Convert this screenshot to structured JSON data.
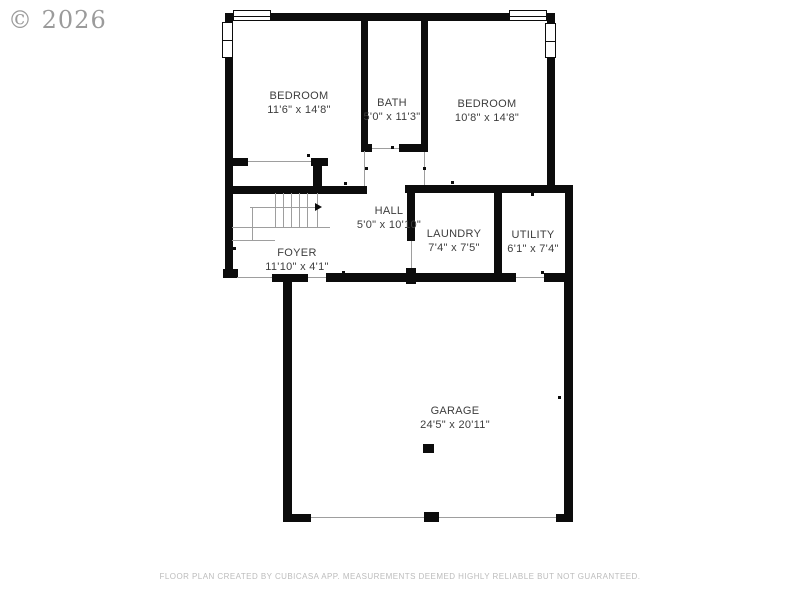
{
  "watermark": "© 2026",
  "rooms": [
    {
      "id": "bedroom-left",
      "label": "BEDROOM",
      "dimensions": "11'6\" x 14'8\""
    },
    {
      "id": "bath",
      "label": "BATH",
      "dimensions": "5'0\" x 11'3\""
    },
    {
      "id": "bedroom-right",
      "label": "BEDROOM",
      "dimensions": "10'8\" x 14'8\""
    },
    {
      "id": "hall",
      "label": "HALL",
      "dimensions": "5'0\" x 10'10\""
    },
    {
      "id": "laundry",
      "label": "LAUNDRY",
      "dimensions": "7'4\" x 7'5\""
    },
    {
      "id": "utility",
      "label": "UTILITY",
      "dimensions": "6'1\" x 7'4\""
    },
    {
      "id": "foyer",
      "label": "FOYER",
      "dimensions": "11'10\" x 4'1\""
    },
    {
      "id": "garage",
      "label": "GARAGE",
      "dimensions": "24'5\" x 20'11\""
    }
  ],
  "footer": {
    "disclaimer": "FLOOR PLAN CREATED BY CUBICASA APP. MEASUREMENTS DEEMED HIGHLY RELIABLE BUT NOT GUARANTEED."
  },
  "colors": {
    "wall": "#0c0c0c",
    "room_label": "#3d3d3d",
    "watermark": "#9b9b9b",
    "footer_text": "#bcbcbc",
    "opening_line": "#9e9e9e",
    "background": "#ffffff"
  }
}
